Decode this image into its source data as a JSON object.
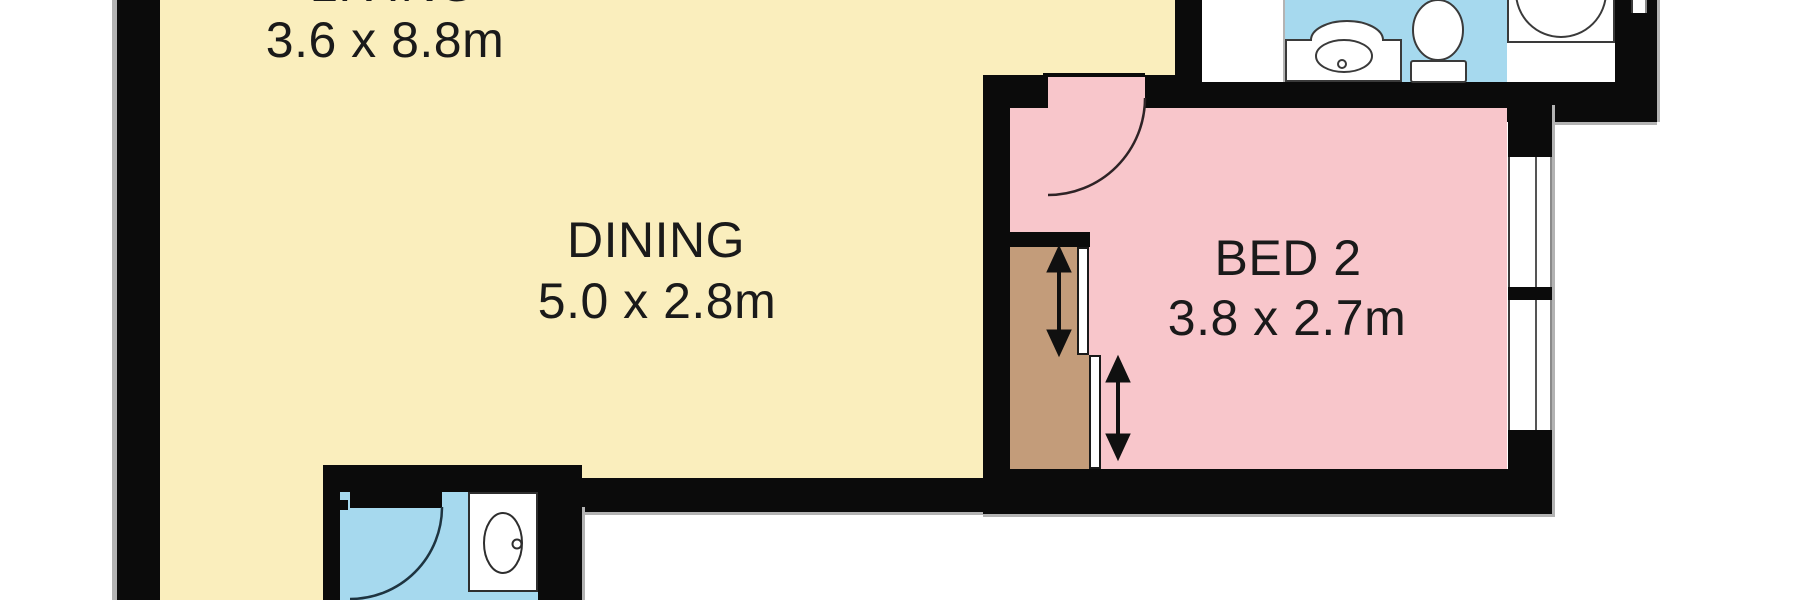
{
  "plan_title": "apartment-floor-plan",
  "rooms": {
    "living": {
      "name": "LIVING",
      "dims": "3.6 x 8.8m",
      "note": "room name cut off at top edge of screenshot"
    },
    "dining": {
      "name": "DINING",
      "dims": "5.0 x 2.8m"
    },
    "bed2": {
      "name": "BED 2",
      "dims": "3.8 x 2.7m"
    }
  },
  "fixtures": [
    "vanity-basin",
    "toilet",
    "shower",
    "wash-basin",
    "wardrobe-sliding-doors"
  ],
  "colors": {
    "wall": "#0b0b0b",
    "floor-living": "#faeebd",
    "floor-bed": "#f8c6cb",
    "floor-bath": "#a6d9ee",
    "wardrobe": "#c39c7a",
    "outline": "#b3b3b3",
    "fixture": "#2e2e2e",
    "text": "#1a1a1a",
    "background": "#ffffff"
  }
}
